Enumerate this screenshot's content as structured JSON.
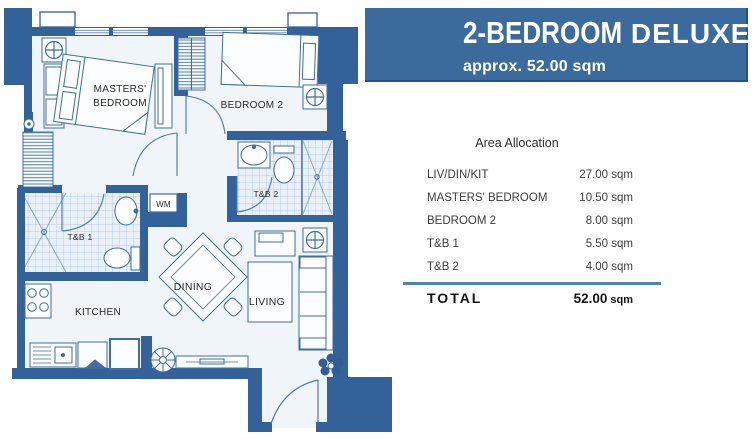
{
  "banner": {
    "title_primary": "2-BEDROOM",
    "title_secondary": "DELUXE",
    "subtitle": "approx. 52.00 sqm",
    "bg_color": "#3a6b9c"
  },
  "area_table": {
    "title": "Area Allocation",
    "rows": [
      {
        "label": "LIV/DIN/KIT",
        "value": "27.00 sqm"
      },
      {
        "label": "MASTERS' BEDROOM",
        "value": "10.50 sqm"
      },
      {
        "label": "BEDROOM 2",
        "value": "8.00 sqm"
      },
      {
        "label": "T&B 1",
        "value": "5.50 sqm"
      },
      {
        "label": "T&B 2",
        "value": "4.00 sqm"
      }
    ],
    "total_label": "TOTAL",
    "total_number": "52.00",
    "total_unit": "sqm"
  },
  "floor_plan": {
    "labels": {
      "masters_line1": "MASTERS'",
      "masters_line2": "BEDROOM",
      "bedroom2": "BEDROOM 2",
      "tb2": "T&B 2",
      "tb1": "T&B 1",
      "wm": "WM",
      "kitchen": "KITCHEN",
      "dining": "DINING",
      "living": "LIVING"
    },
    "colors": {
      "wall": "#33629b",
      "floor": "#f0f5fa",
      "tile": "#e9f0f8",
      "line": "#3f6da4"
    }
  }
}
